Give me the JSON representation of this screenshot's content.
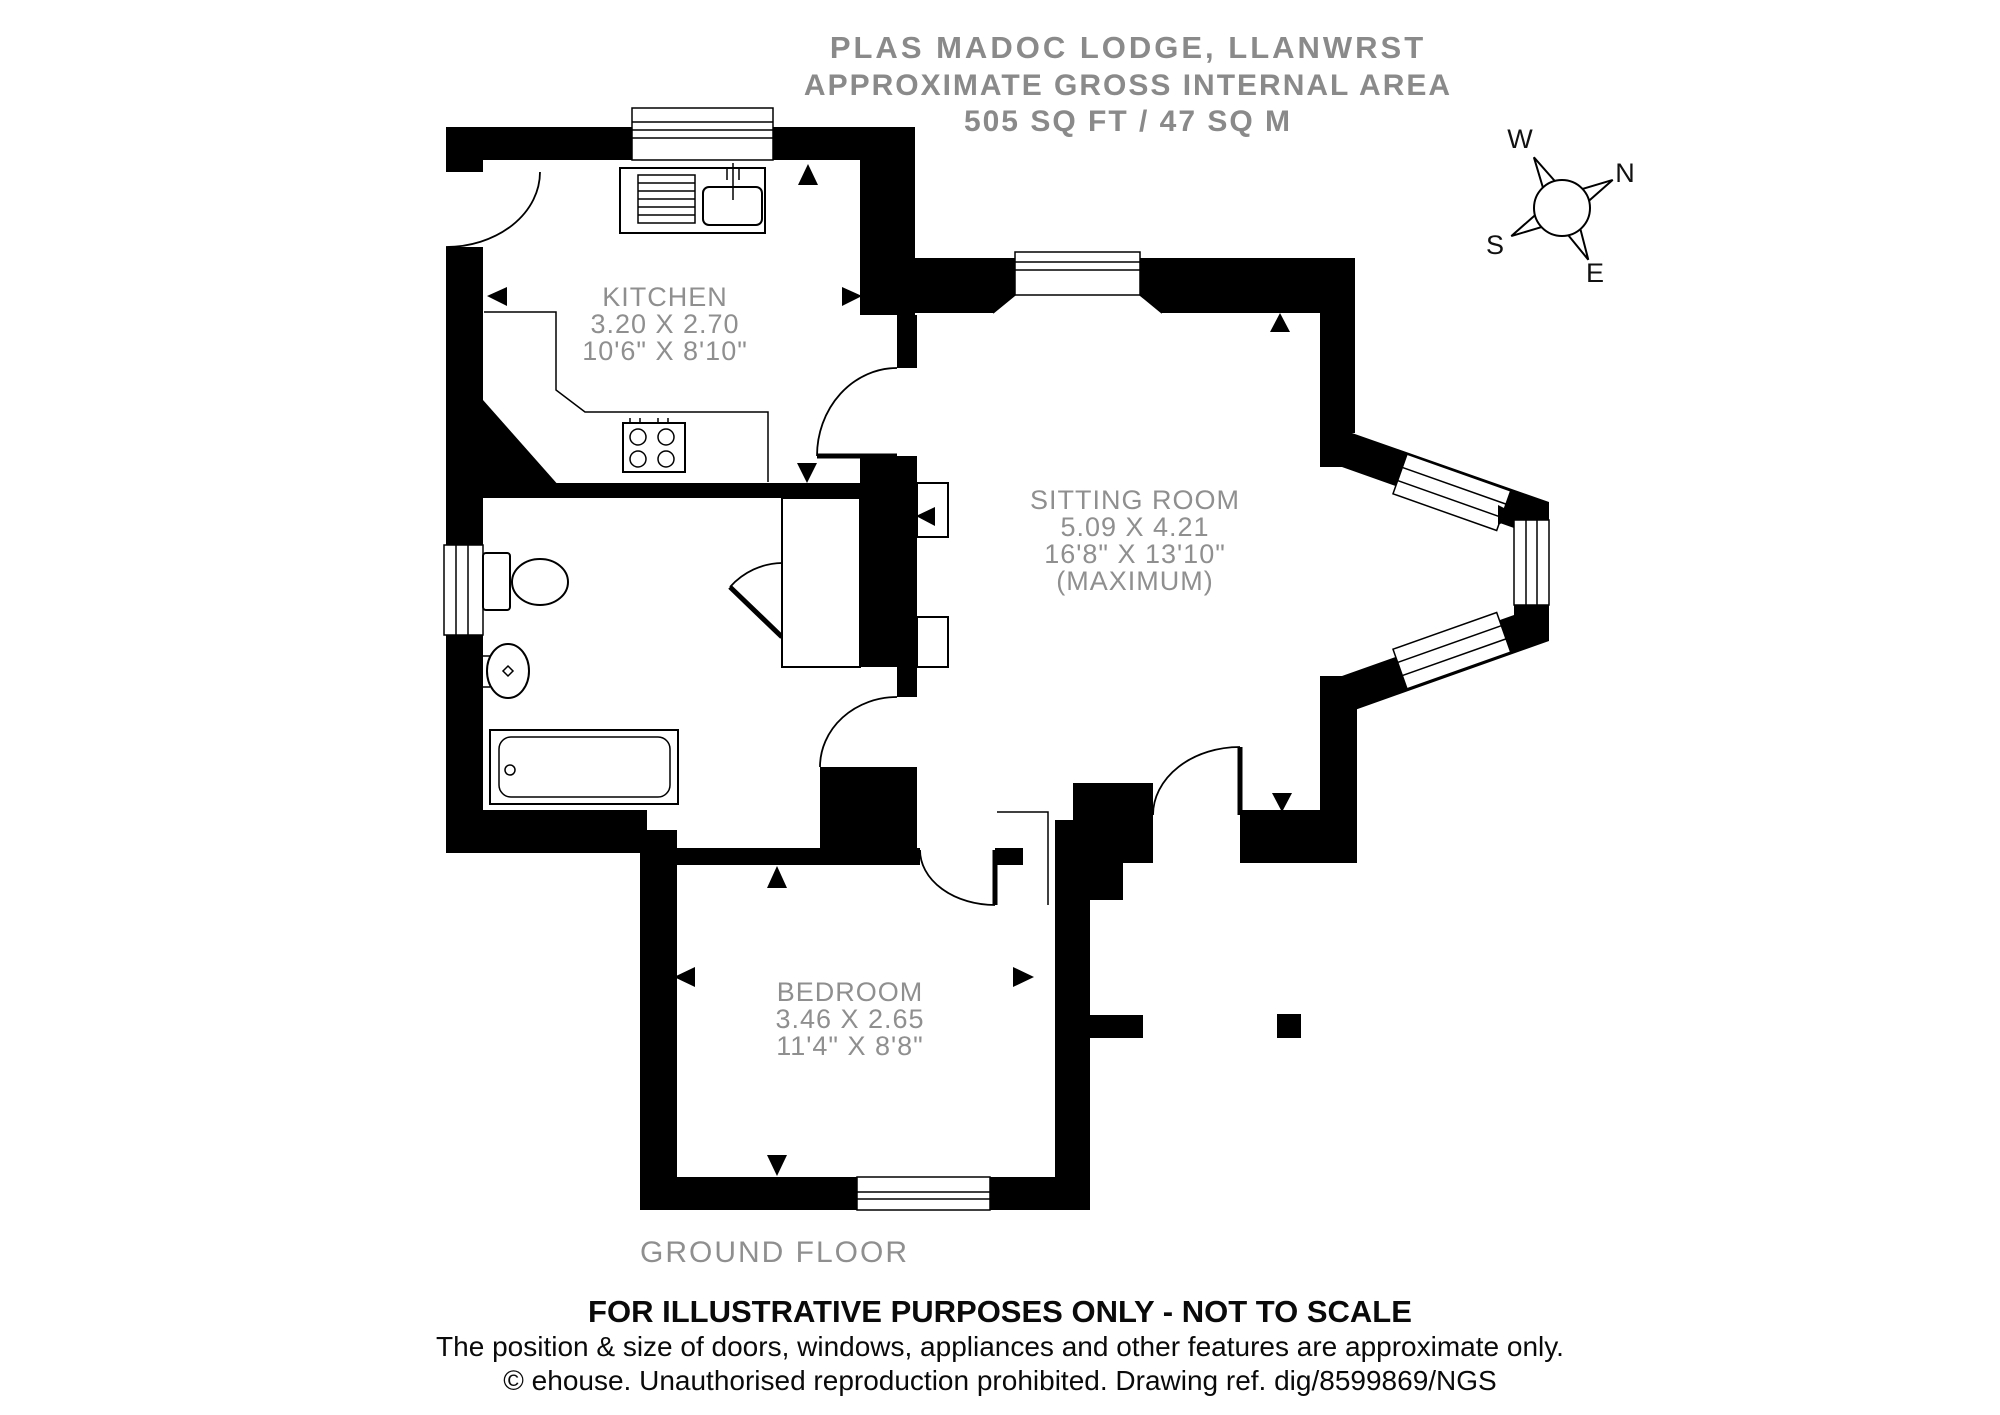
{
  "header": {
    "title": "PLAS MADOC LODGE, LLANWRST",
    "subtitle1": "APPROXIMATE GROSS INTERNAL AREA",
    "subtitle2": "505 SQ FT / 47 SQ M"
  },
  "compass": {
    "n": "N",
    "e": "E",
    "s": "S",
    "w": "W"
  },
  "rooms": {
    "kitchen": {
      "name": "KITCHEN",
      "dims_m": "3.20 X 2.70",
      "dims_ft": "10'6\" X 8'10\""
    },
    "sitting_room": {
      "name": "SITTING ROOM",
      "dims_m": "5.09 X 4.21",
      "dims_ft": "16'8\" X 13'10\"",
      "note": "(MAXIMUM)"
    },
    "bedroom": {
      "name": "BEDROOM",
      "dims_m": "3.46 X 2.65",
      "dims_ft": "11'4\" X 8'8\""
    }
  },
  "floor_label": "GROUND FLOOR",
  "footer": {
    "line1": "FOR ILLUSTRATIVE PURPOSES ONLY - NOT TO SCALE",
    "line2": "The position & size of doors, windows, appliances and other features are approximate only.",
    "line3": "© ehouse. Unauthorised reproduction prohibited. Drawing ref. dig/8599869/NGS"
  },
  "fixtures": [
    "sink-drainer",
    "tap",
    "hob",
    "toilet",
    "wash-basin",
    "bathtub",
    "cupboard",
    "fireplace-units"
  ],
  "colors": {
    "wall": "#000000",
    "label_gray": "#8f8f8f",
    "header_gray": "#8a8a8a",
    "footer_text": "#0a0a0a",
    "background": "#ffffff"
  }
}
